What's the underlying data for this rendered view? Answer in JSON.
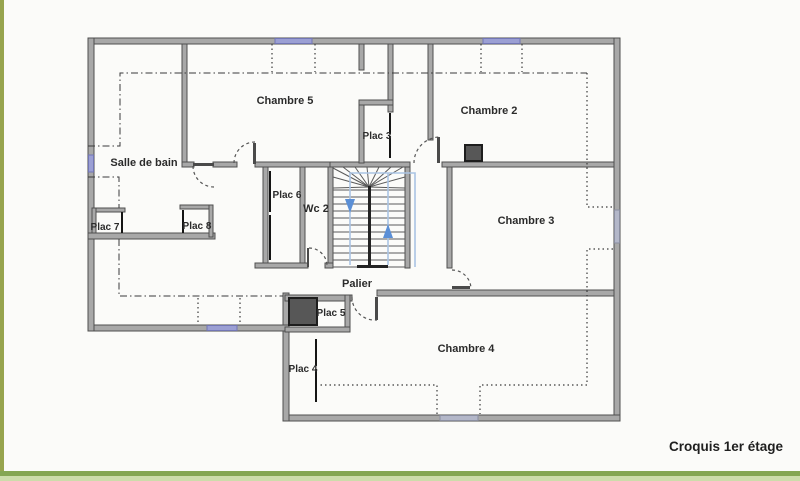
{
  "caption": {
    "text": "Croquis 1er étage"
  },
  "rooms": {
    "salle_de_bain": "Salle de bain",
    "chambre2": "Chambre 2",
    "chambre3": "Chambre 3",
    "chambre4": "Chambre 4",
    "chambre5": "Chambre 5",
    "wc2": "Wc 2",
    "palier": "Palier",
    "plac3": "Plac 3",
    "plac4": "Plac 4",
    "plac5": "Plac 5",
    "plac6": "Plac 6",
    "plac7": "Plac 7",
    "plac8": "Plac 8"
  },
  "colors": {
    "background": "#fbfbf9",
    "wall_fill": "#a8a8a8",
    "wall_edge": "#4f4f4f",
    "window_accent": "#9b9fd4",
    "window_muted": "#b3b7c9",
    "stair_guide_line": "#aac4e4",
    "stair_arrow": "#5b8fd6",
    "chimney_fill": "#575757",
    "frame_left_bar": "#97a44e",
    "frame_bottom_bar": "#85a653",
    "frame_bottom_bar_light": "#cddcab",
    "dashed_lines": "#3a3a3a"
  }
}
